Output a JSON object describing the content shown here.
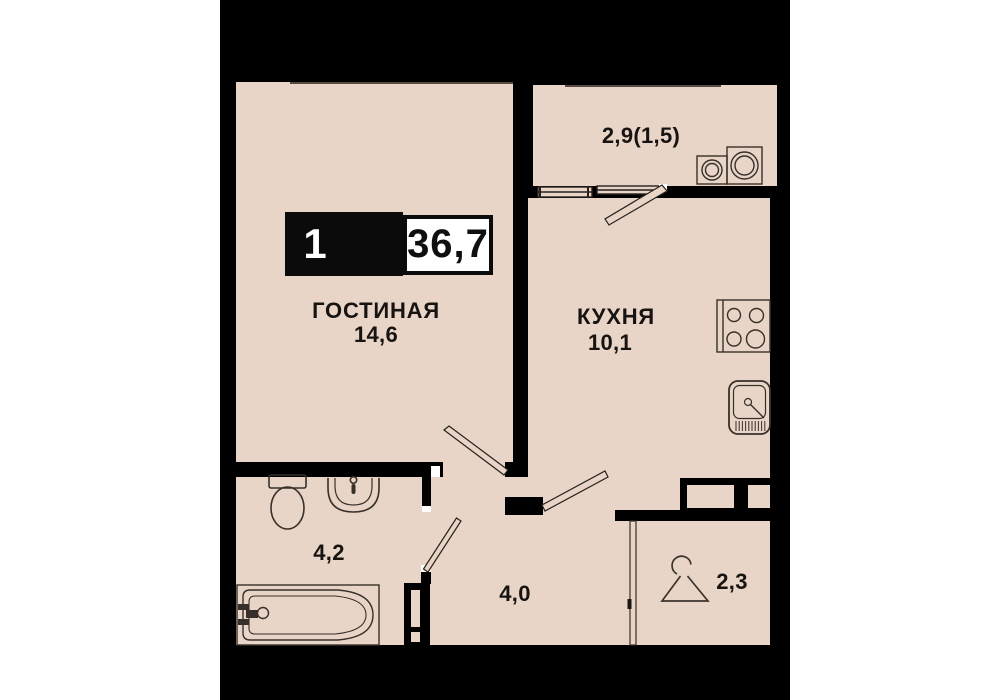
{
  "badge": {
    "rooms_count": "1",
    "total_area": "36,7"
  },
  "rooms": {
    "living": {
      "name": "ГОСТИНАЯ",
      "area": "14,6"
    },
    "kitchen": {
      "name": "КУХНЯ",
      "area": "10,1"
    },
    "balcony": {
      "area": "2,9(1,5)"
    },
    "bathroom": {
      "area": "4,2"
    },
    "hallway": {
      "area": "4,0"
    },
    "closet": {
      "area": "2,3"
    }
  },
  "colors": {
    "floor": "#e8d5c7",
    "background": "#000000",
    "outline": "#37302a",
    "text": "#171310",
    "badge_black": "#0b0b0b",
    "badge_white": "#ffffff"
  },
  "icons": [
    "toilet-icon",
    "wash-basin-icon",
    "bathtub-icon",
    "bath-faucet-icon",
    "vent-shaft-icon",
    "stove-icon",
    "kitchen-sink-icon",
    "washing-machine-icon",
    "dryer-icon",
    "hanger-icon",
    "window-icon",
    "door-leaf-icon",
    "sliding-door-icon"
  ]
}
